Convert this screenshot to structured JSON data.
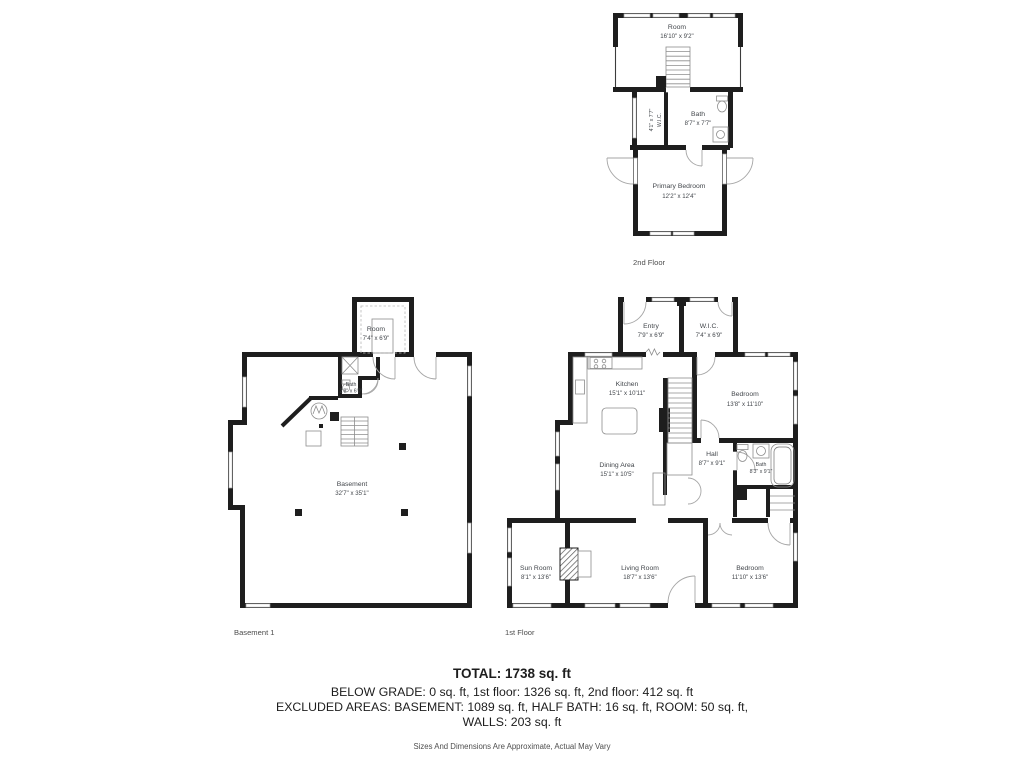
{
  "colors": {
    "wall": "#1e1e1e",
    "room_label": "#43474c",
    "summary_text": "#1d1d1d",
    "disclaimer_text": "#4f4f4f",
    "background": "#ffffff"
  },
  "plans": {
    "second_floor": {
      "label": "2nd Floor",
      "rooms": {
        "attic_room": {
          "name": "Room",
          "dims": "16'10\" x 9'2\""
        },
        "wic": {
          "name": "W.I.C.",
          "dims": "4'1\" x 7'7\""
        },
        "bath": {
          "name": "Bath",
          "dims": "8'7\" x 7'7\""
        },
        "primary_bedroom": {
          "name": "Primary Bedroom",
          "dims": "12'2\" x 12'4\""
        }
      }
    },
    "basement": {
      "label": "Basement 1",
      "rooms": {
        "room": {
          "name": "Room",
          "dims": "7'4\" x 6'9\""
        },
        "bath": {
          "name": "Bath",
          "dims": "2'8\" x 6'0\""
        },
        "basement": {
          "name": "Basement",
          "dims": "32'7\" x 35'1\""
        }
      }
    },
    "first_floor": {
      "label": "1st Floor",
      "rooms": {
        "entry": {
          "name": "Entry",
          "dims": "7'9\" x 6'9\""
        },
        "wic": {
          "name": "W.I.C.",
          "dims": "7'4\" x 6'9\""
        },
        "kitchen": {
          "name": "Kitchen",
          "dims": "15'1\" x 10'11\""
        },
        "bedroom_ne": {
          "name": "Bedroom",
          "dims": "13'8\" x 11'10\""
        },
        "dining": {
          "name": "Dining Area",
          "dims": "15'1\" x 10'5\""
        },
        "hall": {
          "name": "Hall",
          "dims": "8'7\" x 9'1\""
        },
        "bath": {
          "name": "Bath",
          "dims": "8'3\" x 9'1\""
        },
        "sun_room": {
          "name": "Sun Room",
          "dims": "8'1\" x 13'6\""
        },
        "living_room": {
          "name": "Living Room",
          "dims": "18'7\" x 13'6\""
        },
        "bedroom_se": {
          "name": "Bedroom",
          "dims": "11'10\" x 13'6\""
        }
      }
    }
  },
  "summary": {
    "total": "TOTAL: 1738 sq. ft",
    "by_floor": "BELOW GRADE: 0 sq. ft, 1st floor: 1326 sq. ft, 2nd floor: 412 sq. ft",
    "excluded": "EXCLUDED AREAS: BASEMENT: 1089 sq. ft, HALF BATH: 16 sq. ft, ROOM: 50 sq. ft,",
    "excluded2": "WALLS: 203 sq. ft",
    "disclaimer": "Sizes And Dimensions Are Approximate, Actual May Vary"
  }
}
